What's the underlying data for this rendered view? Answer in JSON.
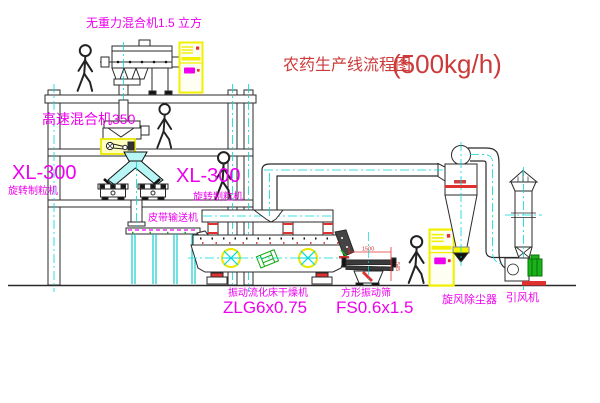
{
  "title": {
    "name": "农药生产线流程图",
    "capacity": "(500kg/h)"
  },
  "labels": {
    "gravity_mixer": "无重力混合机1.5 立方",
    "high_speed_mixer": "高速混合机350",
    "granulator_left_model": "XL-300",
    "granulator_left_name": "旋转制粒机",
    "granulator_right_model": "XL-300",
    "granulator_right_name": "旋转制粒机",
    "belt_conveyor": "皮带输送机",
    "dryer_name": "振动流化床干燥机",
    "dryer_model": "ZLG6x0.75",
    "sieve_name": "方形振动筛",
    "sieve_model": "FS0.6x1.5",
    "cyclone_name": "旋风除尘器",
    "fan_name": "引风机"
  },
  "dimensions": {
    "sieve_length": "1500",
    "sieve_height": "545"
  },
  "colors": {
    "label_magenta": "#ee00ee",
    "title_red": "#cd3a3a",
    "centerline_cyan": "#00d8d8",
    "highlight_yellow": "#f0f000",
    "accent_red": "#e03030",
    "accent_green": "#13a913",
    "line_black": "#2a2a2a"
  }
}
